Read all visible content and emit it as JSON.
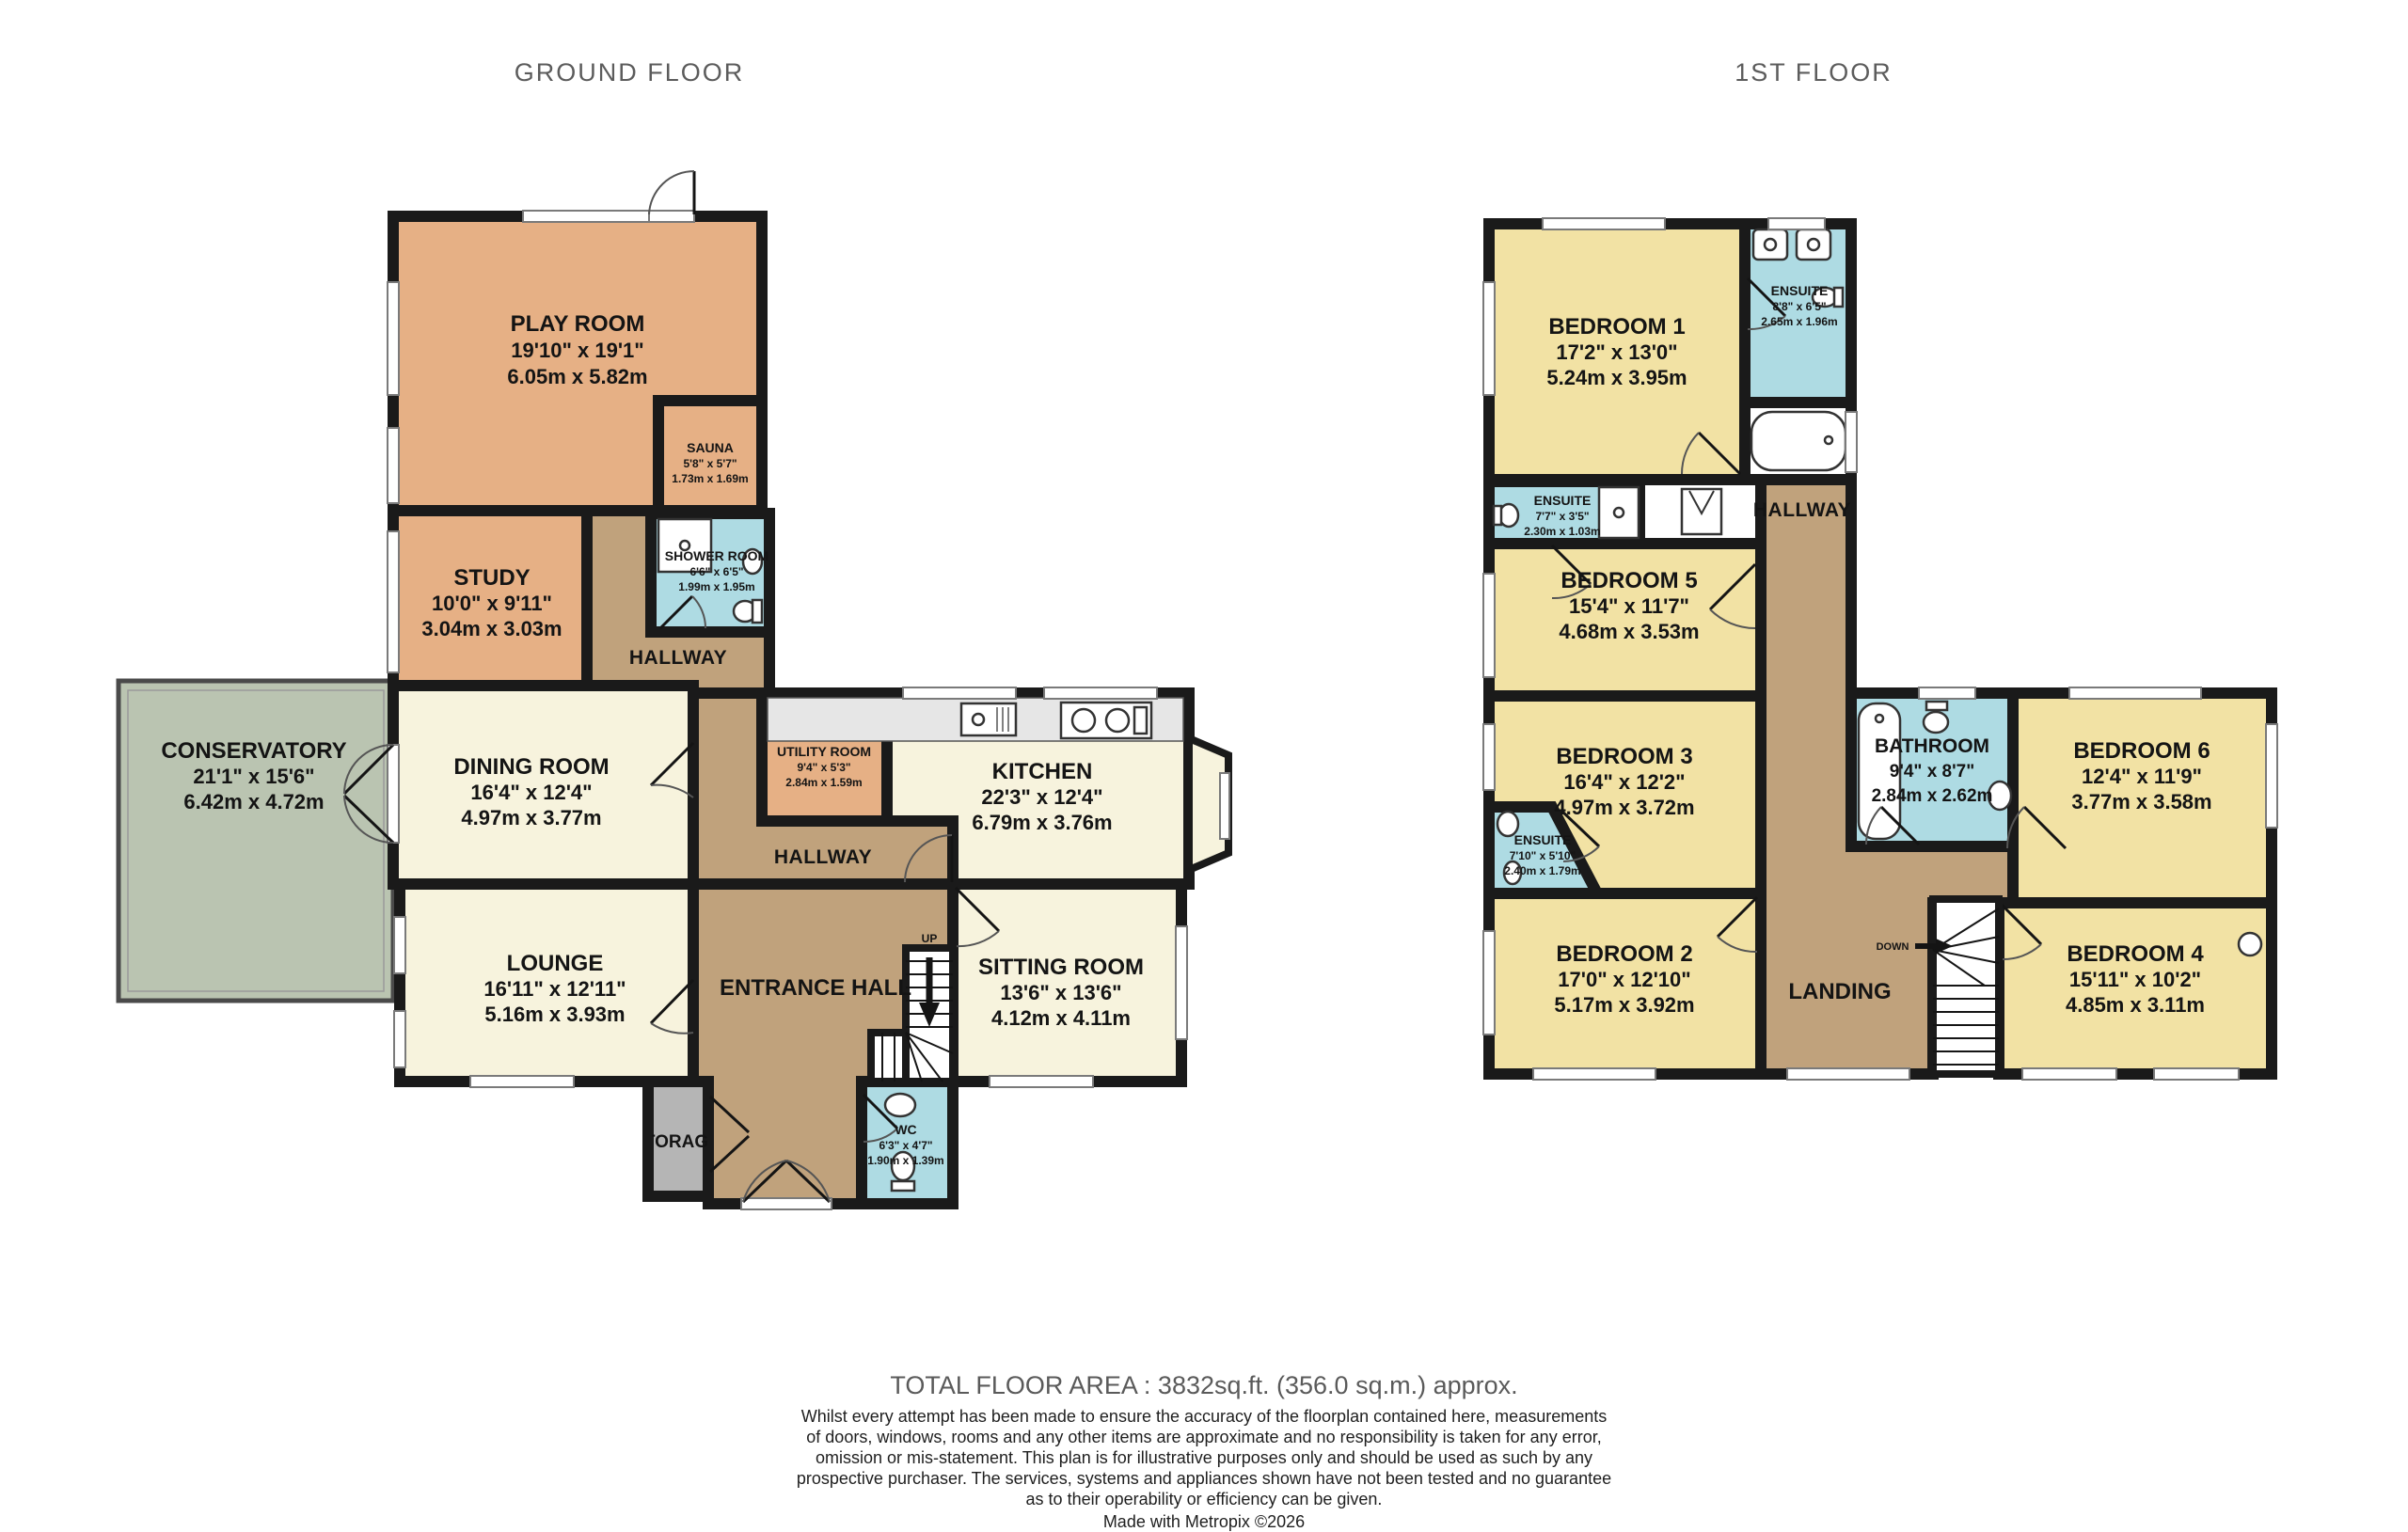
{
  "colors": {
    "wall": "#1a1a1a",
    "orange": "#e6b085",
    "cream": "#f7f3dd",
    "green": "#bac4b1",
    "blue": "#aedbe3",
    "yellow": "#f2e2a4",
    "brown": "#c0a27c",
    "storage_gray": "#b5b5b5",
    "counter_gray": "#e6e6e6",
    "title_gray": "#5c5c5c"
  },
  "ground": {
    "title": "GROUND FLOOR",
    "play_room": {
      "name": "PLAY ROOM",
      "imperial": "19'10\"  x 19'1\"",
      "metric": "6.05m  x 5.82m"
    },
    "sauna": {
      "name": "SAUNA",
      "imperial": "5'8\"  x 5'7\"",
      "metric": "1.73m  x 1.69m"
    },
    "study": {
      "name": "STUDY",
      "imperial": "10'0\"  x 9'11\"",
      "metric": "3.04m  x 3.03m"
    },
    "shower_room": {
      "name": "SHOWER ROOM",
      "imperial": "6'6\"  x 6'5\"",
      "metric": "1.99m  x 1.95m"
    },
    "hallway_upper": {
      "name": "HALLWAY"
    },
    "conservatory": {
      "name": "CONSERVATORY",
      "imperial": "21'1\"  x 15'6\"",
      "metric": "6.42m  x 4.72m"
    },
    "dining_room": {
      "name": "DINING ROOM",
      "imperial": "16'4\"  x 12'4\"",
      "metric": "4.97m  x 3.77m"
    },
    "utility_room": {
      "name": "UTILITY ROOM",
      "imperial": "9'4\"  x 5'3\"",
      "metric": "2.84m  x 1.59m"
    },
    "kitchen": {
      "name": "KITCHEN",
      "imperial": "22'3\"  x 12'4\"",
      "metric": "6.79m  x 3.76m"
    },
    "hallway_middle": {
      "name": "HALLWAY"
    },
    "lounge": {
      "name": "LOUNGE",
      "imperial": "16'11\"  x 12'11\"",
      "metric": "5.16m  x 3.93m"
    },
    "entrance_hall": {
      "name": "ENTRANCE HALL"
    },
    "sitting_room": {
      "name": "SITTING ROOM",
      "imperial": "13'6\"  x 13'6\"",
      "metric": "4.12m  x 4.11m"
    },
    "storage": {
      "name": "STORAGE"
    },
    "wc": {
      "name": "WC",
      "imperial": "6'3\"  x 4'7\"",
      "metric": "1.90m  x 1.39m"
    },
    "stairs_label": "UP"
  },
  "first": {
    "title": "1ST FLOOR",
    "bedroom_1": {
      "name": "BEDROOM 1",
      "imperial": "17'2\"  x 13'0\"",
      "metric": "5.24m  x 3.95m"
    },
    "ensuite_1": {
      "name": "ENSUITE",
      "imperial": "8'8\"  x 6'5\"",
      "metric": "2.65m  x 1.96m"
    },
    "hallway": {
      "name": "HALLWAY"
    },
    "ensuite_5": {
      "name": "ENSUITE",
      "imperial": "7'7\"  x 3'5\"",
      "metric": "2.30m  x 1.03m"
    },
    "bedroom_5": {
      "name": "BEDROOM 5",
      "imperial": "15'4\"  x 11'7\"",
      "metric": "4.68m  x 3.53m"
    },
    "bedroom_3": {
      "name": "BEDROOM 3",
      "imperial": "16'4\"  x 12'2\"",
      "metric": "4.97m  x 3.72m"
    },
    "ensuite_3": {
      "name": "ENSUITE",
      "imperial": "7'10\"  x 5'10\"",
      "metric": "2.40m  x 1.79m"
    },
    "bathroom": {
      "name": "BATHROOM",
      "imperial": "9'4\"  x 8'7\"",
      "metric": "2.84m  x 2.62m"
    },
    "bedroom_6": {
      "name": "BEDROOM 6",
      "imperial": "12'4\"  x 11'9\"",
      "metric": "3.77m  x 3.58m"
    },
    "bedroom_2": {
      "name": "BEDROOM 2",
      "imperial": "17'0\"  x 12'10\"",
      "metric": "5.17m  x 3.92m"
    },
    "landing": {
      "name": "LANDING"
    },
    "bedroom_4": {
      "name": "BEDROOM 4",
      "imperial": "15'11\"  x 10'2\"",
      "metric": "4.85m  x 3.11m"
    },
    "stairs_label": "DOWN"
  },
  "footer": {
    "total": "TOTAL FLOOR AREA : 3832sq.ft. (356.0 sq.m.) approx.",
    "disclaimer_lines": [
      "Whilst every attempt has been made to ensure the accuracy of the floorplan contained here, measurements",
      "of doors, windows, rooms and any other items are approximate and no responsibility is taken for any error,",
      "omission or mis-statement. This plan is for illustrative purposes only and should be used as such by any",
      "prospective purchaser. The services, systems and appliances shown have not been tested and no guarantee",
      "as to their operability or efficiency can be given."
    ],
    "credit": "Made with Metropix ©2026"
  }
}
